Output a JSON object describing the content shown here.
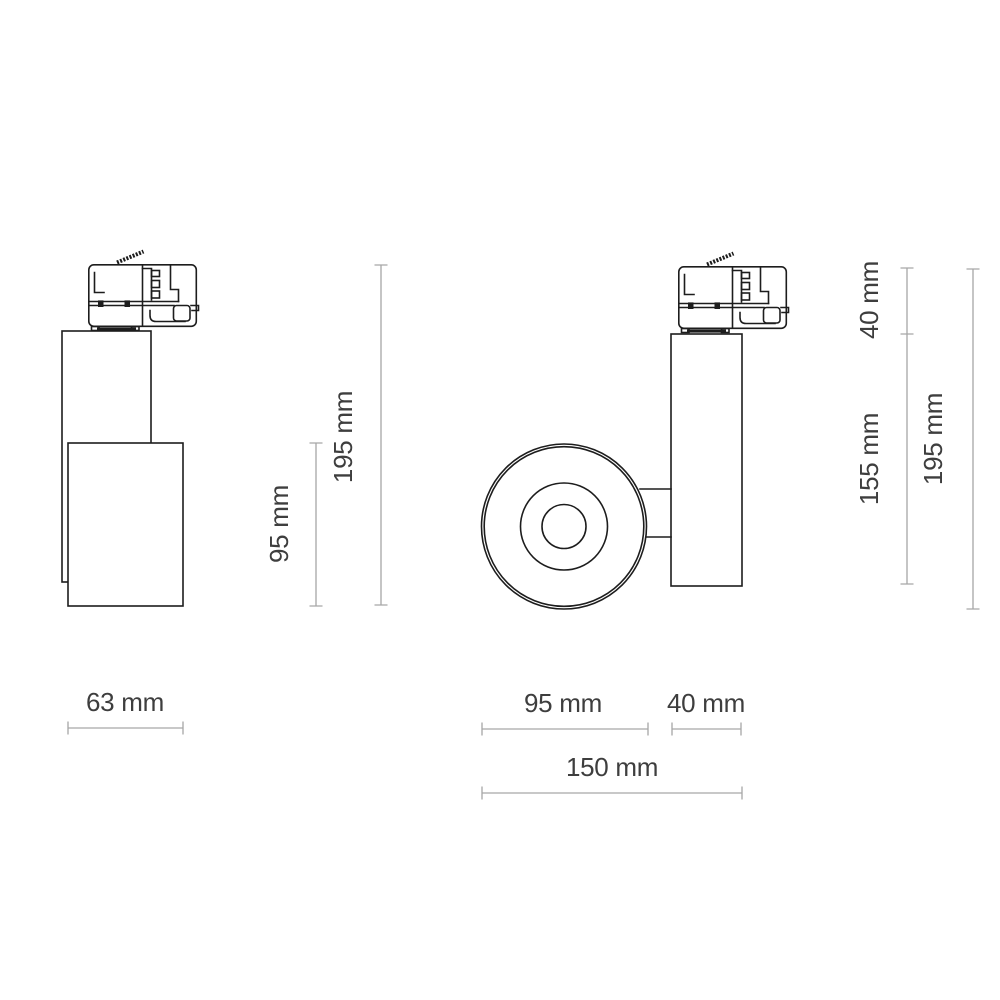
{
  "theme": {
    "background": "#ffffff",
    "outline": "#1d1d1d",
    "dim_line": "#a6a6a6",
    "label": "#3e3e3e"
  },
  "dims": {
    "front_height_95": "95 mm",
    "front_height_195": "195 mm",
    "front_width_63": "63 mm",
    "side_height_40": "40 mm",
    "side_height_155": "155 mm",
    "side_height_195": "195 mm",
    "side_width_95": "95 mm",
    "side_width_40": "40 mm",
    "side_width_150": "150 mm"
  }
}
